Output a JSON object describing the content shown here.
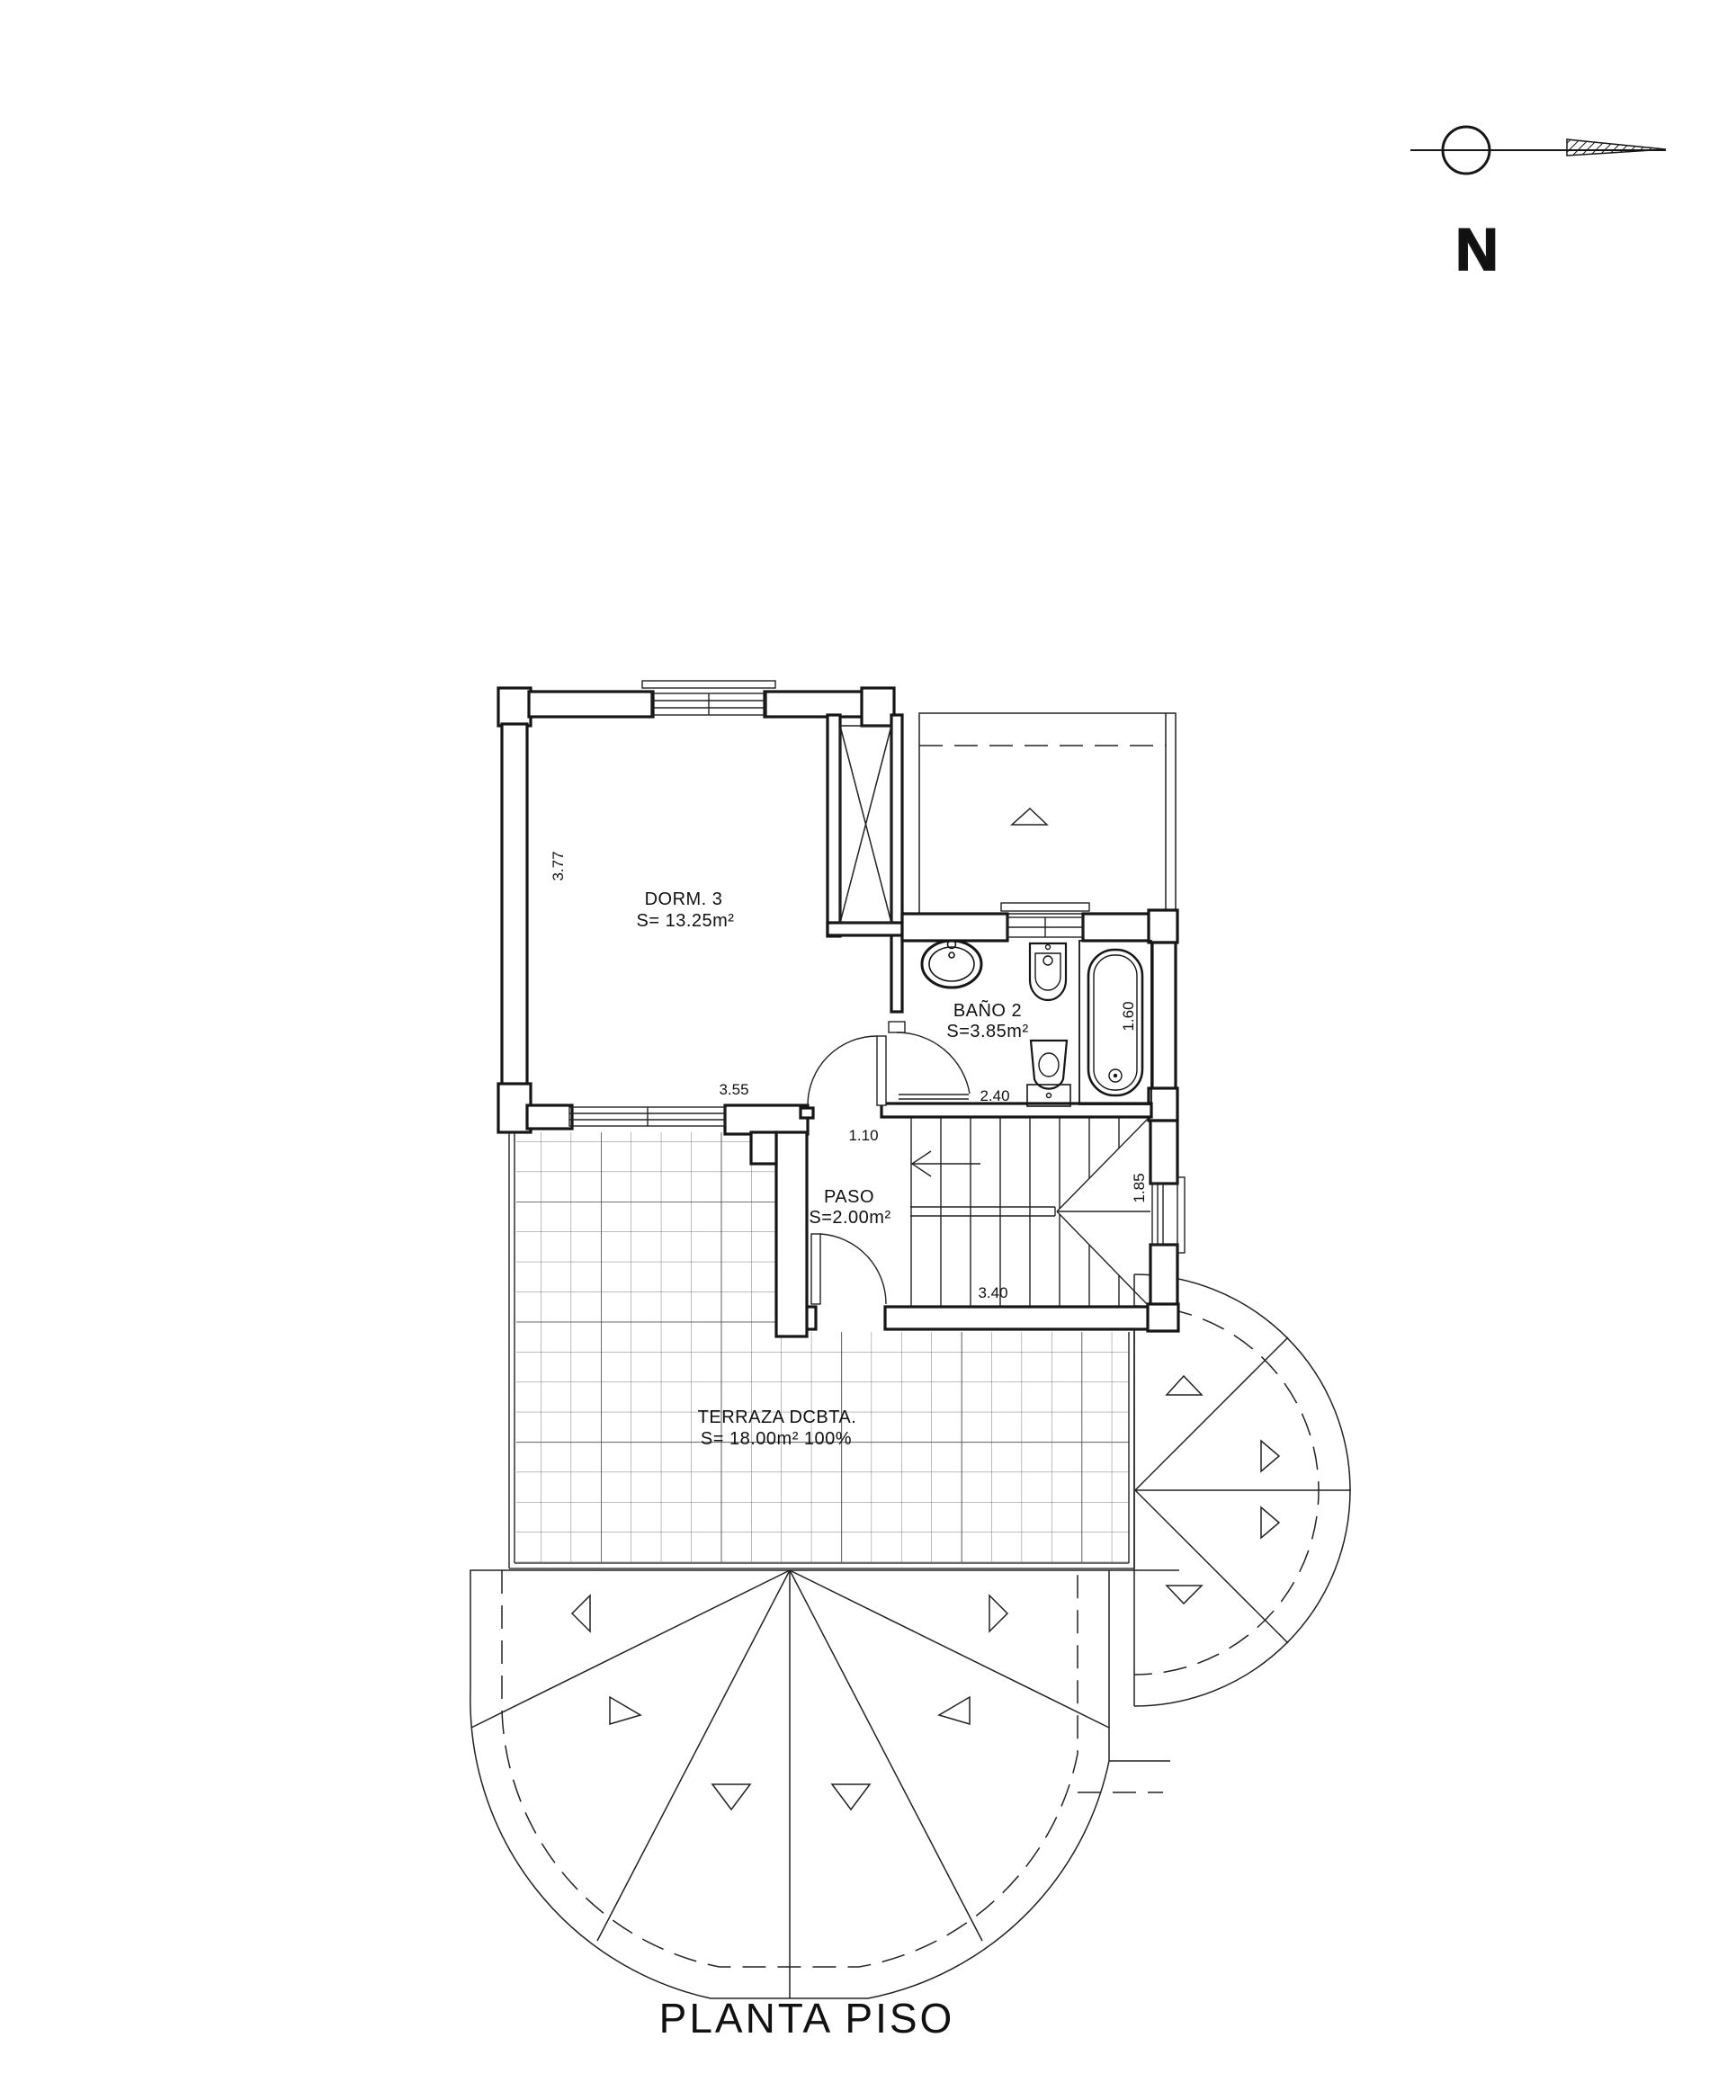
{
  "drawing": {
    "title": "PLANTA PISO",
    "type_note": "architectural floor plan, first floor",
    "line_color": "#1a1a1a",
    "grid_color": "#7a7a7a",
    "background": "#ffffff"
  },
  "north_indicator": {
    "letter": "N"
  },
  "rooms": {
    "dorm3": {
      "name": "DORM. 3",
      "area": "S= 13.25m²"
    },
    "bano2": {
      "name": "BAÑO 2",
      "area": "S=3.85m²"
    },
    "paso": {
      "name": "PASO",
      "area": "S=2.00m²"
    },
    "terraza": {
      "name": "TERRAZA DCBTA.",
      "area": "S= 18.00m² 100%"
    }
  },
  "dimensions": {
    "dorm3_height": "3.77",
    "dorm3_width": "3.55",
    "paso_door_width": "1.10",
    "bano2_width": "2.40",
    "bath_length": "1.60",
    "stair_window": "1.85",
    "stair_width": "3.40"
  }
}
